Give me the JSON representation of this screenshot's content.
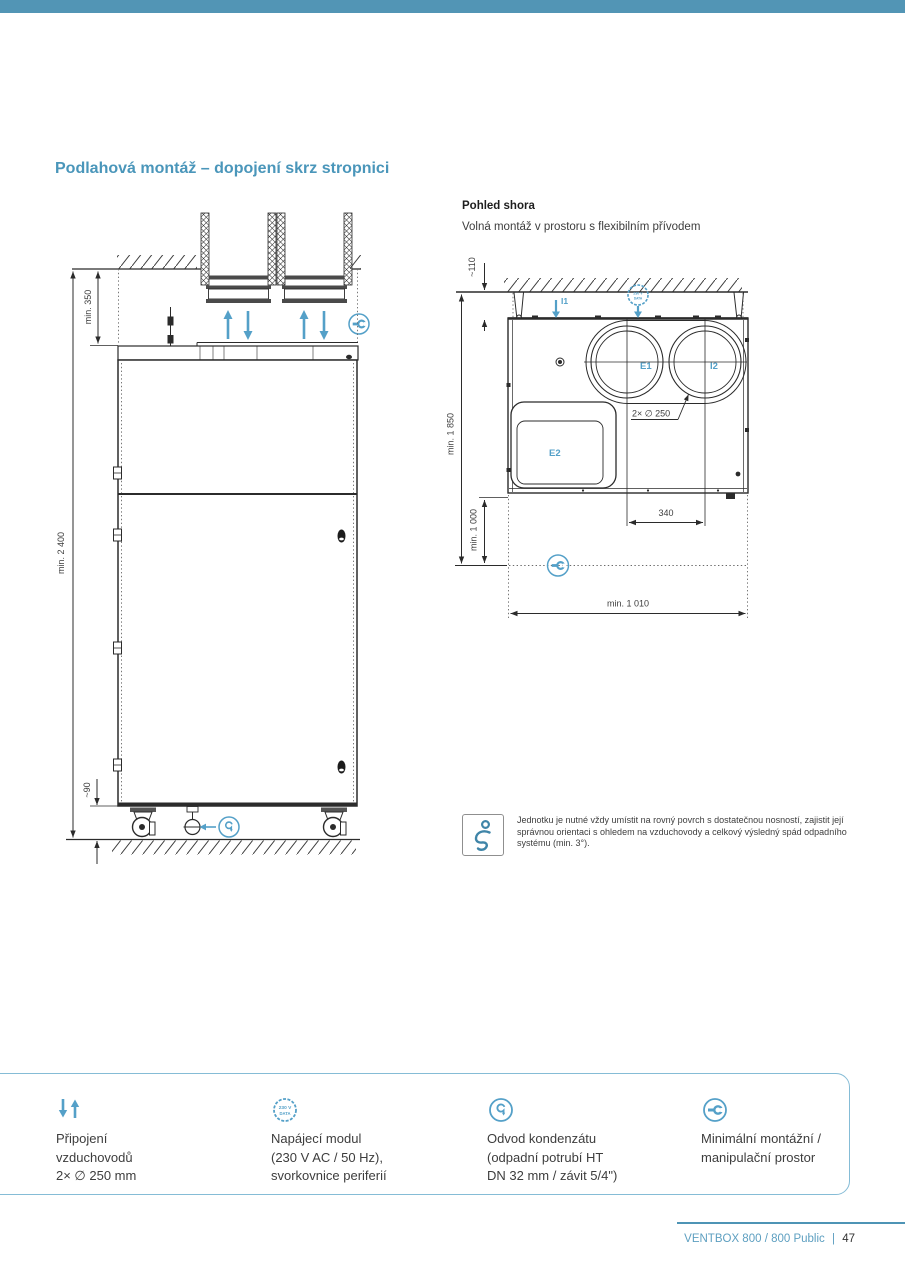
{
  "colors": {
    "top_bar": "#5295b5",
    "title": "#4a96ba",
    "diagram_blue": "#54a0c8",
    "legend_border": "#85bcd6",
    "footer_blue": "#5d9fc0"
  },
  "page_title": "Podlahová montáž – dopojení skrz stropnici",
  "front_view": {
    "dim_top_clearance": "min. 350",
    "dim_total_height": "min. 2 400",
    "dim_base_height": "~90"
  },
  "top_view": {
    "heading": "Pohled shora",
    "subtitle": "Volná montáž v prostoru s flexibilním přívodem",
    "dim_wall_gap": "~110",
    "dim_height_total": "min. 1 850",
    "dim_front_clearance": "min. 1 000",
    "dim_duct_spacing": "340",
    "dim_width_total": "min. 1 010",
    "duct_note": "2× ∅ 250",
    "label_i1": "I1",
    "label_e1": "E1",
    "label_i2": "I2",
    "label_e2": "E2"
  },
  "power_badge": {
    "line1": "230 V",
    "line2": "DATA"
  },
  "note": {
    "text": "Jednotku je nutné vždy umístit na rovný povrch s dostatečnou nosností, zajistit její správnou orientaci s ohledem na vzduchovody a celkový výsledný spád odpadního systému (min. 3°)."
  },
  "legend": {
    "items": [
      {
        "icon": "airflow-arrows-icon",
        "line1": "Připojení",
        "line2": "vzduchovodů",
        "line3": "2× ∅ 250 mm"
      },
      {
        "icon": "power-data-icon",
        "line1": "Napájecí modul",
        "line2": "(230 V AC / 50 Hz),",
        "line3": "svorkovnice periferií"
      },
      {
        "icon": "condensate-drain-icon",
        "line1": "Odvod kondenzátu",
        "line2": "(odpadní potrubí HT",
        "line3": "DN 32 mm / závit 5/4\")"
      },
      {
        "icon": "service-space-icon",
        "line1": "Minimální montážní /",
        "line2": "manipulační prostor",
        "line3": ""
      }
    ]
  },
  "footer": {
    "brand": "VENTBOX 800 / 800 Public",
    "separator": "|",
    "page_number": "47"
  }
}
